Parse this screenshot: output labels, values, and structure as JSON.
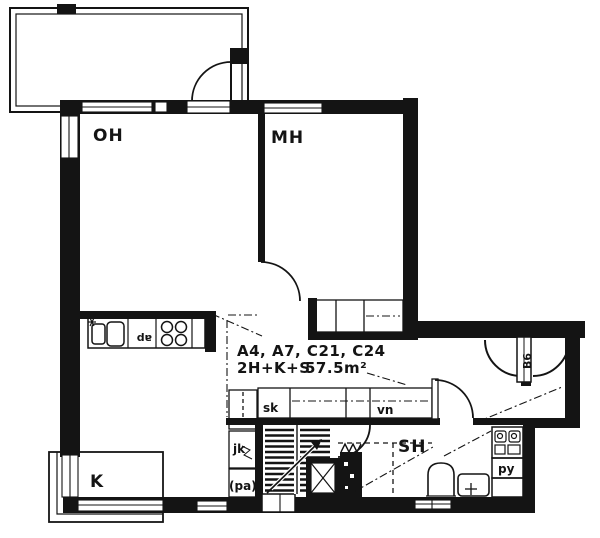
{
  "labels": {
    "room_oh": "OH",
    "room_mh": "MH",
    "room_k": "K",
    "room_sh": "SH",
    "apartments": "A4, A7, C21, C24",
    "layout": "2H+K+S",
    "area": "57.5m²",
    "closet_sk": "sk",
    "closet_vn": "vn",
    "fridge_jk": "jk",
    "freezer_pa": "(pa)",
    "laundry_py": "py",
    "dishwasher_ap": "ap",
    "entry_door": "B6"
  },
  "colors": {
    "ink": "#141414",
    "paper": "#ffffff"
  }
}
